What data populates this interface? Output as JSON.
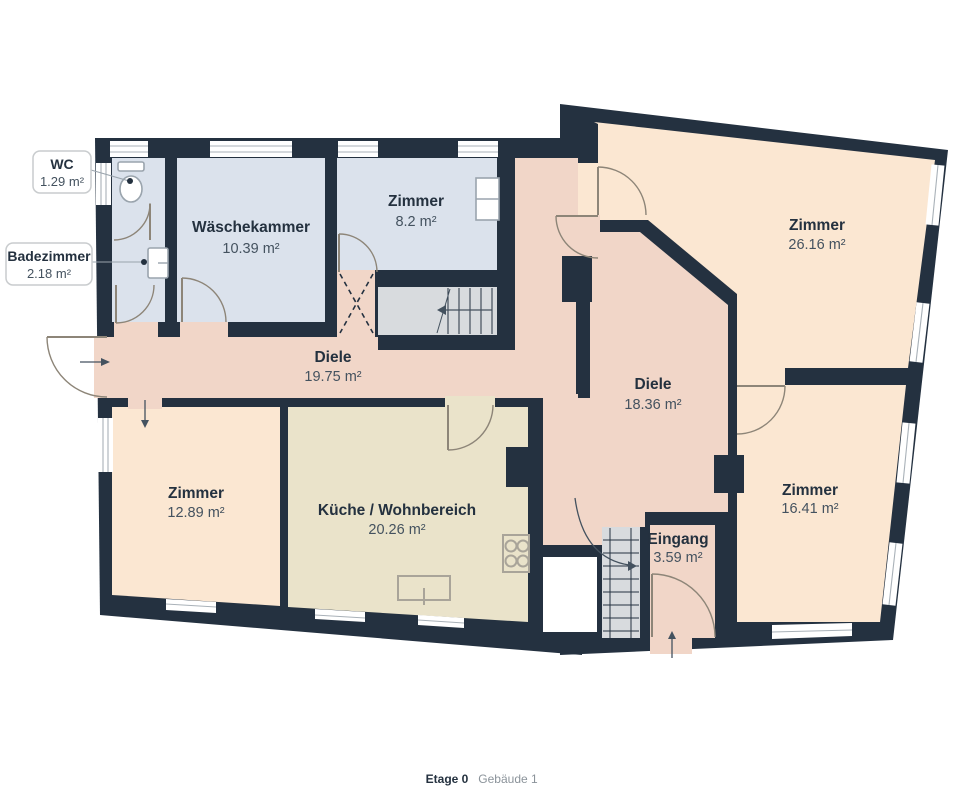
{
  "plan": {
    "rooms": [
      {
        "key": "waeschekammer",
        "name": "Wäschekammer",
        "area": "10.39 m²"
      },
      {
        "key": "zimmer_klein",
        "name": "Zimmer",
        "area": "8.2 m²"
      },
      {
        "key": "zimmer_gross",
        "name": "Zimmer",
        "area": "26.16 m²"
      },
      {
        "key": "diele_links",
        "name": "Diele",
        "area": "19.75 m²"
      },
      {
        "key": "diele_rechts",
        "name": "Diele",
        "area": "18.36 m²"
      },
      {
        "key": "zimmer_links",
        "name": "Zimmer",
        "area": "12.89 m²"
      },
      {
        "key": "kueche",
        "name": "Küche / Wohnbereich",
        "area": "20.26 m²"
      },
      {
        "key": "zimmer_rechts",
        "name": "Zimmer",
        "area": "16.41 m²"
      },
      {
        "key": "eingang",
        "name": "Eingang",
        "area": "3.59 m²"
      }
    ],
    "callouts": [
      {
        "key": "wc",
        "name": "WC",
        "area": "1.29 m²"
      },
      {
        "key": "badezimmer",
        "name": "Badezimmer",
        "area": "2.18 m²"
      }
    ]
  },
  "footer": {
    "floor": "Etage 0",
    "building": "Gebäude 1"
  },
  "colors": {
    "wall": "#243140",
    "room_blue": "#dbe2ec",
    "room_salmon": "#f1d6c8",
    "room_peach": "#fbe7d2",
    "room_beige": "#eae3ca",
    "stairs": "#d8dbde",
    "void": "#ffffff",
    "label": "#24313f",
    "area_label": "#44525f",
    "footer_muted": "#8b939a"
  }
}
